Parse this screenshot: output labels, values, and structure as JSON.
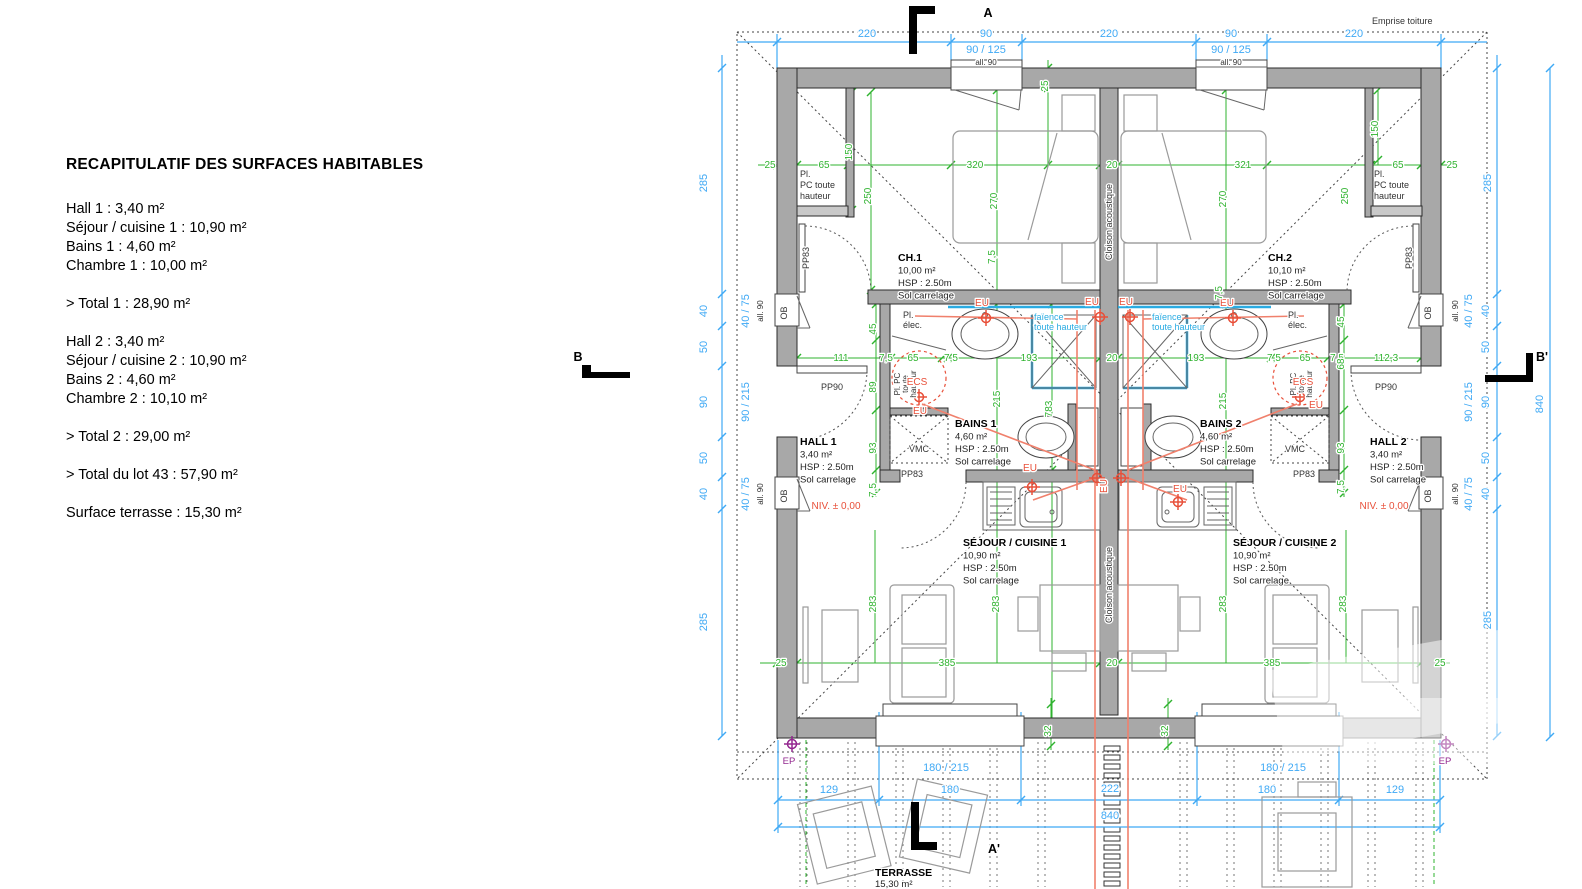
{
  "recap": {
    "title": "RECAPITULATIF DES SURFACES HABITABLES",
    "lines": [
      "Hall 1 : 3,40 m²",
      "Séjour / cuisine 1 : 10,90 m²",
      "Bains 1 : 4,60 m²",
      "Chambre 1 : 10,00 m²",
      "> Total 1 : 28,90 m²",
      "Hall 2 : 3,40 m²",
      "Séjour / cuisine 2 : 10,90 m²",
      "Bains 2 : 4,60 m²",
      "Chambre 2 : 10,10 m²",
      "> Total 2 : 29,00 m²",
      "> Total du lot 43 : 57,90 m²",
      "Surface terrasse : 15,30 m²"
    ]
  },
  "plan": {
    "colors": {
      "dim_blue": "#3fa9f5",
      "dim_green": "#2fb32f",
      "plumbing_red": "#e8503a",
      "rainwater_purple": "#93278f",
      "tile_blue": "#29abe2",
      "wall_gray": "#a8a8a8"
    },
    "texts": [
      {
        "x": 867,
        "y": 37,
        "text": "220",
        "cls": "cb"
      },
      {
        "x": 986,
        "y": 37,
        "text": "90",
        "cls": "cb"
      },
      {
        "x": 1109,
        "y": 37,
        "text": "220",
        "cls": "cb"
      },
      {
        "x": 1231,
        "y": 37,
        "text": "90",
        "cls": "cb"
      },
      {
        "x": 1354,
        "y": 37,
        "text": "220",
        "cls": "cb"
      },
      {
        "x": 986,
        "y": 53,
        "text": "90 / 125",
        "cls": "cb"
      },
      {
        "x": 1231,
        "y": 53,
        "text": "90 / 125",
        "cls": "cb"
      },
      {
        "x": 986,
        "y": 65,
        "text": "all. 90",
        "cls": "ct"
      },
      {
        "x": 1231,
        "y": 65,
        "text": "all. 90",
        "cls": "ct"
      },
      {
        "x": 1372,
        "y": 24,
        "text": "Emprise toiture",
        "cls": "ck",
        "a": "start"
      },
      {
        "x": 988,
        "y": 17,
        "text": "A",
        "cls": "cm",
        "name": "section-marker-a"
      },
      {
        "x": 994,
        "y": 853,
        "text": "A'",
        "cls": "cm",
        "name": "section-marker-a-prime"
      },
      {
        "x": 578,
        "y": 361,
        "text": "B",
        "cls": "cm",
        "name": "section-marker-b"
      },
      {
        "x": 1542,
        "y": 361,
        "text": "B'",
        "cls": "cm",
        "name": "section-marker-b-prime"
      },
      {
        "x": 707,
        "y": 183,
        "text": "285",
        "cls": "cb",
        "rot": -90
      },
      {
        "x": 707,
        "y": 311,
        "text": "40",
        "cls": "cb",
        "rot": -90
      },
      {
        "x": 707,
        "y": 347,
        "text": "50",
        "cls": "cb",
        "rot": -90
      },
      {
        "x": 707,
        "y": 402,
        "text": "90",
        "cls": "cb",
        "rot": -90
      },
      {
        "x": 707,
        "y": 458,
        "text": "50",
        "cls": "cb",
        "rot": -90
      },
      {
        "x": 707,
        "y": 494,
        "text": "40",
        "cls": "cb",
        "rot": -90
      },
      {
        "x": 707,
        "y": 622,
        "text": "285",
        "cls": "cb",
        "rot": -90
      },
      {
        "x": 749,
        "y": 311,
        "text": "40 / 75",
        "cls": "cb",
        "rot": -90
      },
      {
        "x": 763,
        "y": 311,
        "text": "all. 90",
        "cls": "ct",
        "rot": -90
      },
      {
        "x": 749,
        "y": 402,
        "text": "90 / 215",
        "cls": "cb",
        "rot": -90
      },
      {
        "x": 749,
        "y": 494,
        "text": "40 / 75",
        "cls": "cb",
        "rot": -90
      },
      {
        "x": 763,
        "y": 494,
        "text": "all. 90",
        "cls": "ct",
        "rot": -90
      },
      {
        "x": 1491,
        "y": 183,
        "text": "285",
        "cls": "cb",
        "rot": -90
      },
      {
        "x": 1489,
        "y": 311,
        "text": "40",
        "cls": "cb",
        "rot": -90
      },
      {
        "x": 1489,
        "y": 347,
        "text": "50",
        "cls": "cb",
        "rot": -90
      },
      {
        "x": 1489,
        "y": 402,
        "text": "90",
        "cls": "cb",
        "rot": -90
      },
      {
        "x": 1489,
        "y": 458,
        "text": "50",
        "cls": "cb",
        "rot": -90
      },
      {
        "x": 1489,
        "y": 494,
        "text": "40",
        "cls": "cb",
        "rot": -90
      },
      {
        "x": 1491,
        "y": 620,
        "text": "285",
        "cls": "cb",
        "rot": -90
      },
      {
        "x": 1472,
        "y": 311,
        "text": "40 / 75",
        "cls": "cb",
        "rot": -90
      },
      {
        "x": 1458,
        "y": 311,
        "text": "all. 90",
        "cls": "ct",
        "rot": -90
      },
      {
        "x": 1472,
        "y": 402,
        "text": "90 / 215",
        "cls": "cb",
        "rot": -90
      },
      {
        "x": 1472,
        "y": 494,
        "text": "40 / 75",
        "cls": "cb",
        "rot": -90
      },
      {
        "x": 1458,
        "y": 494,
        "text": "all. 90",
        "cls": "ct",
        "rot": -90
      },
      {
        "x": 1543,
        "y": 404,
        "text": "840",
        "cls": "cb",
        "rot": -90
      },
      {
        "x": 946,
        "y": 771,
        "text": "180 / 215",
        "cls": "cb"
      },
      {
        "x": 1283,
        "y": 771,
        "text": "180 / 215",
        "cls": "cb"
      },
      {
        "x": 829,
        "y": 793,
        "text": "129",
        "cls": "cb"
      },
      {
        "x": 950,
        "y": 793,
        "text": "180",
        "cls": "cb"
      },
      {
        "x": 1110,
        "y": 792,
        "text": "222",
        "cls": "cb"
      },
      {
        "x": 1267,
        "y": 793,
        "text": "180",
        "cls": "cb"
      },
      {
        "x": 1395,
        "y": 793,
        "text": "129",
        "cls": "cb"
      },
      {
        "x": 1110,
        "y": 819,
        "text": "840",
        "cls": "cb"
      },
      {
        "x": 787,
        "y": 313,
        "text": "OB",
        "cls": "ck",
        "rot": -90
      },
      {
        "x": 787,
        "y": 496,
        "text": "OB",
        "cls": "ck",
        "rot": -90
      },
      {
        "x": 1431,
        "y": 313,
        "text": "OB",
        "cls": "ck",
        "rot": -90
      },
      {
        "x": 1431,
        "y": 496,
        "text": "OB",
        "cls": "ck",
        "rot": -90
      },
      {
        "x": 832,
        "y": 390,
        "text": "PP90",
        "cls": "ck"
      },
      {
        "x": 1386,
        "y": 390,
        "text": "PP90",
        "cls": "ck"
      },
      {
        "x": 809,
        "y": 258,
        "text": "PP83",
        "cls": "ck",
        "rot": -90
      },
      {
        "x": 1412,
        "y": 258,
        "text": "PP83",
        "cls": "ck",
        "rot": -90
      },
      {
        "x": 912,
        "y": 477,
        "text": "PP83",
        "cls": "ck"
      },
      {
        "x": 1304,
        "y": 477,
        "text": "PP83",
        "cls": "ck"
      },
      {
        "x": 800,
        "y": 177,
        "lines": [
          "Pl.",
          "PC toute",
          "hauteur"
        ],
        "cls": "ck",
        "a": "start",
        "lh": 11
      },
      {
        "x": 1374,
        "y": 177,
        "lines": [
          "Pl.",
          "PC toute",
          "hauteur"
        ],
        "cls": "ck",
        "a": "start",
        "lh": 11
      },
      {
        "x": 898,
        "y": 261,
        "lines": [
          "CH.1",
          "10,00 m²",
          "HSP : 2.50m",
          "Sol carrelage"
        ],
        "cls": "crm",
        "a": "start",
        "lh": 12.5,
        "b": true,
        "name": "room-ch1"
      },
      {
        "x": 1268,
        "y": 261,
        "lines": [
          "CH.2",
          "10,10 m²",
          "HSP : 2.50m",
          "Sol carrelage"
        ],
        "cls": "crm",
        "a": "start",
        "lh": 12.5,
        "b": true,
        "name": "room-ch2"
      },
      {
        "x": 955,
        "y": 427,
        "lines": [
          "BAINS 1",
          "4,60 m²",
          "HSP : 2.50m",
          "Sol carrelage"
        ],
        "cls": "crm",
        "a": "start",
        "lh": 12.5,
        "b": true,
        "name": "room-bains1"
      },
      {
        "x": 1200,
        "y": 427,
        "lines": [
          "BAINS 2",
          "4,60 m²",
          "HSP : 2.50m",
          "Sol carrelage"
        ],
        "cls": "crm",
        "a": "start",
        "lh": 12.5,
        "b": true,
        "name": "room-bains2"
      },
      {
        "x": 800,
        "y": 445,
        "lines": [
          "HALL 1",
          "3,40 m²",
          "HSP : 2.50m",
          "Sol carrelage"
        ],
        "cls": "crm",
        "a": "start",
        "lh": 12.5,
        "b": true,
        "name": "room-hall1"
      },
      {
        "x": 1370,
        "y": 445,
        "lines": [
          "HALL 2",
          "3,40 m²",
          "HSP : 2.50m",
          "Sol carrelage"
        ],
        "cls": "crm",
        "a": "start",
        "lh": 12.5,
        "b": true,
        "name": "room-hall2"
      },
      {
        "x": 963,
        "y": 546,
        "lines": [
          "SÉJOUR / CUISINE 1",
          "10,90 m²",
          "HSP : 2.50m",
          "Sol carrelage"
        ],
        "cls": "crm",
        "a": "start",
        "lh": 12.5,
        "b": true,
        "name": "room-sejour1"
      },
      {
        "x": 1233,
        "y": 546,
        "lines": [
          "SÉJOUR / CUISINE 2",
          "10,90 m²",
          "HSP : 2.50m",
          "Sol carrelage"
        ],
        "cls": "crm",
        "a": "start",
        "lh": 12.5,
        "b": true,
        "name": "room-sejour2"
      },
      {
        "x": 875,
        "y": 876,
        "lines": [
          "TERRASSE",
          "15,30 m²"
        ],
        "cls": "crm",
        "a": "start",
        "lh": 11,
        "b": true,
        "name": "room-terrasse"
      },
      {
        "x": 1112,
        "y": 222,
        "text": "Cloison acoustique",
        "cls": "ck",
        "rot": -90
      },
      {
        "x": 1112,
        "y": 585,
        "text": "Cloison acoustique",
        "cls": "ck",
        "rot": -90
      },
      {
        "x": 1034,
        "y": 320,
        "lines": [
          "faïence",
          "toute hauteur"
        ],
        "cls": "cc",
        "a": "start",
        "lh": 10
      },
      {
        "x": 1152,
        "y": 320,
        "lines": [
          "faïence",
          "toute hauteur"
        ],
        "cls": "cc",
        "a": "start",
        "lh": 10
      },
      {
        "x": 903,
        "y": 318,
        "lines": [
          "Pl.",
          "élec."
        ],
        "cls": "ck",
        "a": "start",
        "lh": 10
      },
      {
        "x": 1288,
        "y": 318,
        "lines": [
          "Pl.",
          "élec."
        ],
        "cls": "ck",
        "a": "start",
        "lh": 10
      },
      {
        "x": 900,
        "y": 384,
        "lines": [
          "Pl. PC",
          "toute",
          "hauteur"
        ],
        "cls": "ct",
        "rot": -90,
        "lh": 8
      },
      {
        "x": 1296,
        "y": 384,
        "lines": [
          "Pl. PC",
          "toute",
          "hauteur"
        ],
        "cls": "ct",
        "rot": -90,
        "lh": 8
      },
      {
        "x": 917,
        "y": 385,
        "text": "ECS",
        "cls": "cr"
      },
      {
        "x": 1303,
        "y": 385,
        "text": "ECS",
        "cls": "cr"
      },
      {
        "x": 920,
        "y": 414,
        "text": "EU",
        "cls": "cr"
      },
      {
        "x": 1316,
        "y": 408,
        "text": "EU",
        "cls": "cr"
      },
      {
        "x": 982,
        "y": 306,
        "text": "EU",
        "cls": "cr"
      },
      {
        "x": 1092,
        "y": 305,
        "text": "EU",
        "cls": "cr"
      },
      {
        "x": 1126,
        "y": 305,
        "text": "EU",
        "cls": "cr"
      },
      {
        "x": 1227,
        "y": 306,
        "text": "EU",
        "cls": "cr"
      },
      {
        "x": 1030,
        "y": 471,
        "text": "EU",
        "cls": "cr"
      },
      {
        "x": 1107,
        "y": 486,
        "text": "EU",
        "cls": "cr",
        "rot": -90
      },
      {
        "x": 1180,
        "y": 492,
        "text": "EU",
        "cls": "cr"
      },
      {
        "x": 836,
        "y": 509,
        "text": "NIV. ± 0,00",
        "cls": "cr"
      },
      {
        "x": 1384,
        "y": 509,
        "text": "NIV. ± 0,00",
        "cls": "cr"
      },
      {
        "x": 919,
        "y": 452,
        "text": "VMC",
        "cls": "ck"
      },
      {
        "x": 1295,
        "y": 452,
        "text": "VMC",
        "cls": "ck"
      },
      {
        "x": 789,
        "y": 764,
        "text": "EP",
        "cls": "cp"
      },
      {
        "x": 1445,
        "y": 764,
        "text": "EP",
        "cls": "cp"
      },
      {
        "x": 770,
        "y": 168,
        "text": "25",
        "cls": "cg"
      },
      {
        "x": 824,
        "y": 168,
        "text": "65",
        "cls": "cg"
      },
      {
        "x": 975,
        "y": 168,
        "text": "320",
        "cls": "cg"
      },
      {
        "x": 1112,
        "y": 168,
        "text": "20",
        "cls": "cg"
      },
      {
        "x": 1243,
        "y": 168,
        "text": "321",
        "cls": "cg"
      },
      {
        "x": 1398,
        "y": 168,
        "text": "65",
        "cls": "cg"
      },
      {
        "x": 1452,
        "y": 168,
        "text": "25",
        "cls": "cg"
      },
      {
        "x": 852,
        "y": 152,
        "text": "150",
        "cls": "cg",
        "rot": -90
      },
      {
        "x": 871,
        "y": 196,
        "text": "250",
        "cls": "cg",
        "rot": -90
      },
      {
        "x": 997,
        "y": 201,
        "text": "270",
        "cls": "cg",
        "rot": -90
      },
      {
        "x": 1048,
        "y": 86,
        "text": "25",
        "cls": "cg",
        "rot": -90
      },
      {
        "x": 1226,
        "y": 199,
        "text": "270",
        "cls": "cg",
        "rot": -90
      },
      {
        "x": 1348,
        "y": 196,
        "text": "250",
        "cls": "cg",
        "rot": -90
      },
      {
        "x": 1378,
        "y": 129,
        "text": "150",
        "cls": "cg",
        "rot": -90
      },
      {
        "x": 995,
        "y": 257,
        "text": "7,5",
        "cls": "cg",
        "rot": -90
      },
      {
        "x": 1222,
        "y": 293,
        "text": "7,5",
        "cls": "cg",
        "rot": -90
      },
      {
        "x": 841,
        "y": 361,
        "text": "111",
        "cls": "cg"
      },
      {
        "x": 886,
        "y": 361,
        "text": "7,5",
        "cls": "cg"
      },
      {
        "x": 913,
        "y": 361,
        "text": "65",
        "cls": "cg"
      },
      {
        "x": 951,
        "y": 361,
        "text": "7,5",
        "cls": "cg"
      },
      {
        "x": 1029,
        "y": 361,
        "text": "193",
        "cls": "cg"
      },
      {
        "x": 1112,
        "y": 361,
        "text": "20",
        "cls": "cg"
      },
      {
        "x": 1196,
        "y": 361,
        "text": "193",
        "cls": "cg"
      },
      {
        "x": 1274,
        "y": 361,
        "text": "7,5",
        "cls": "cg"
      },
      {
        "x": 1305,
        "y": 361,
        "text": "65",
        "cls": "cg"
      },
      {
        "x": 1337,
        "y": 361,
        "text": "7,5",
        "cls": "cg"
      },
      {
        "x": 1386,
        "y": 361,
        "text": "112,3",
        "cls": "cg"
      },
      {
        "x": 876,
        "y": 329,
        "text": "45",
        "cls": "cg",
        "rot": -90
      },
      {
        "x": 876,
        "y": 387,
        "text": "89",
        "cls": "cg",
        "rot": -90
      },
      {
        "x": 876,
        "y": 448,
        "text": "93",
        "cls": "cg",
        "rot": -90
      },
      {
        "x": 876,
        "y": 490,
        "text": "7,5",
        "cls": "cg",
        "rot": -90
      },
      {
        "x": 1344,
        "y": 322,
        "text": "45",
        "cls": "cg",
        "rot": -90
      },
      {
        "x": 1344,
        "y": 364,
        "text": "68",
        "cls": "cg",
        "rot": -90
      },
      {
        "x": 1344,
        "y": 448,
        "text": "93",
        "cls": "cg",
        "rot": -90
      },
      {
        "x": 1344,
        "y": 487,
        "text": "7,5",
        "cls": "cg",
        "rot": -90
      },
      {
        "x": 1000,
        "y": 399,
        "text": "215",
        "cls": "cg",
        "rot": -90
      },
      {
        "x": 1226,
        "y": 401,
        "text": "215",
        "cls": "cg",
        "rot": -90
      },
      {
        "x": 1052,
        "y": 409,
        "text": "783",
        "cls": "cg",
        "rot": -90
      },
      {
        "x": 781,
        "y": 666,
        "text": "25",
        "cls": "cg"
      },
      {
        "x": 947,
        "y": 666,
        "text": "385",
        "cls": "cg"
      },
      {
        "x": 1112,
        "y": 666,
        "text": "20",
        "cls": "cg"
      },
      {
        "x": 1272,
        "y": 666,
        "text": "385",
        "cls": "cg"
      },
      {
        "x": 1440,
        "y": 666,
        "text": "25",
        "cls": "cg"
      },
      {
        "x": 876,
        "y": 604,
        "text": "283",
        "cls": "cg",
        "rot": -90
      },
      {
        "x": 999,
        "y": 604,
        "text": "283",
        "cls": "cg",
        "rot": -90
      },
      {
        "x": 1226,
        "y": 604,
        "text": "283",
        "cls": "cg",
        "rot": -90
      },
      {
        "x": 1346,
        "y": 604,
        "text": "283",
        "cls": "cg",
        "rot": -90
      },
      {
        "x": 1051,
        "y": 731,
        "text": "32",
        "cls": "cg",
        "rot": -90
      },
      {
        "x": 1168,
        "y": 731,
        "text": "32",
        "cls": "cg",
        "rot": -90
      }
    ]
  }
}
